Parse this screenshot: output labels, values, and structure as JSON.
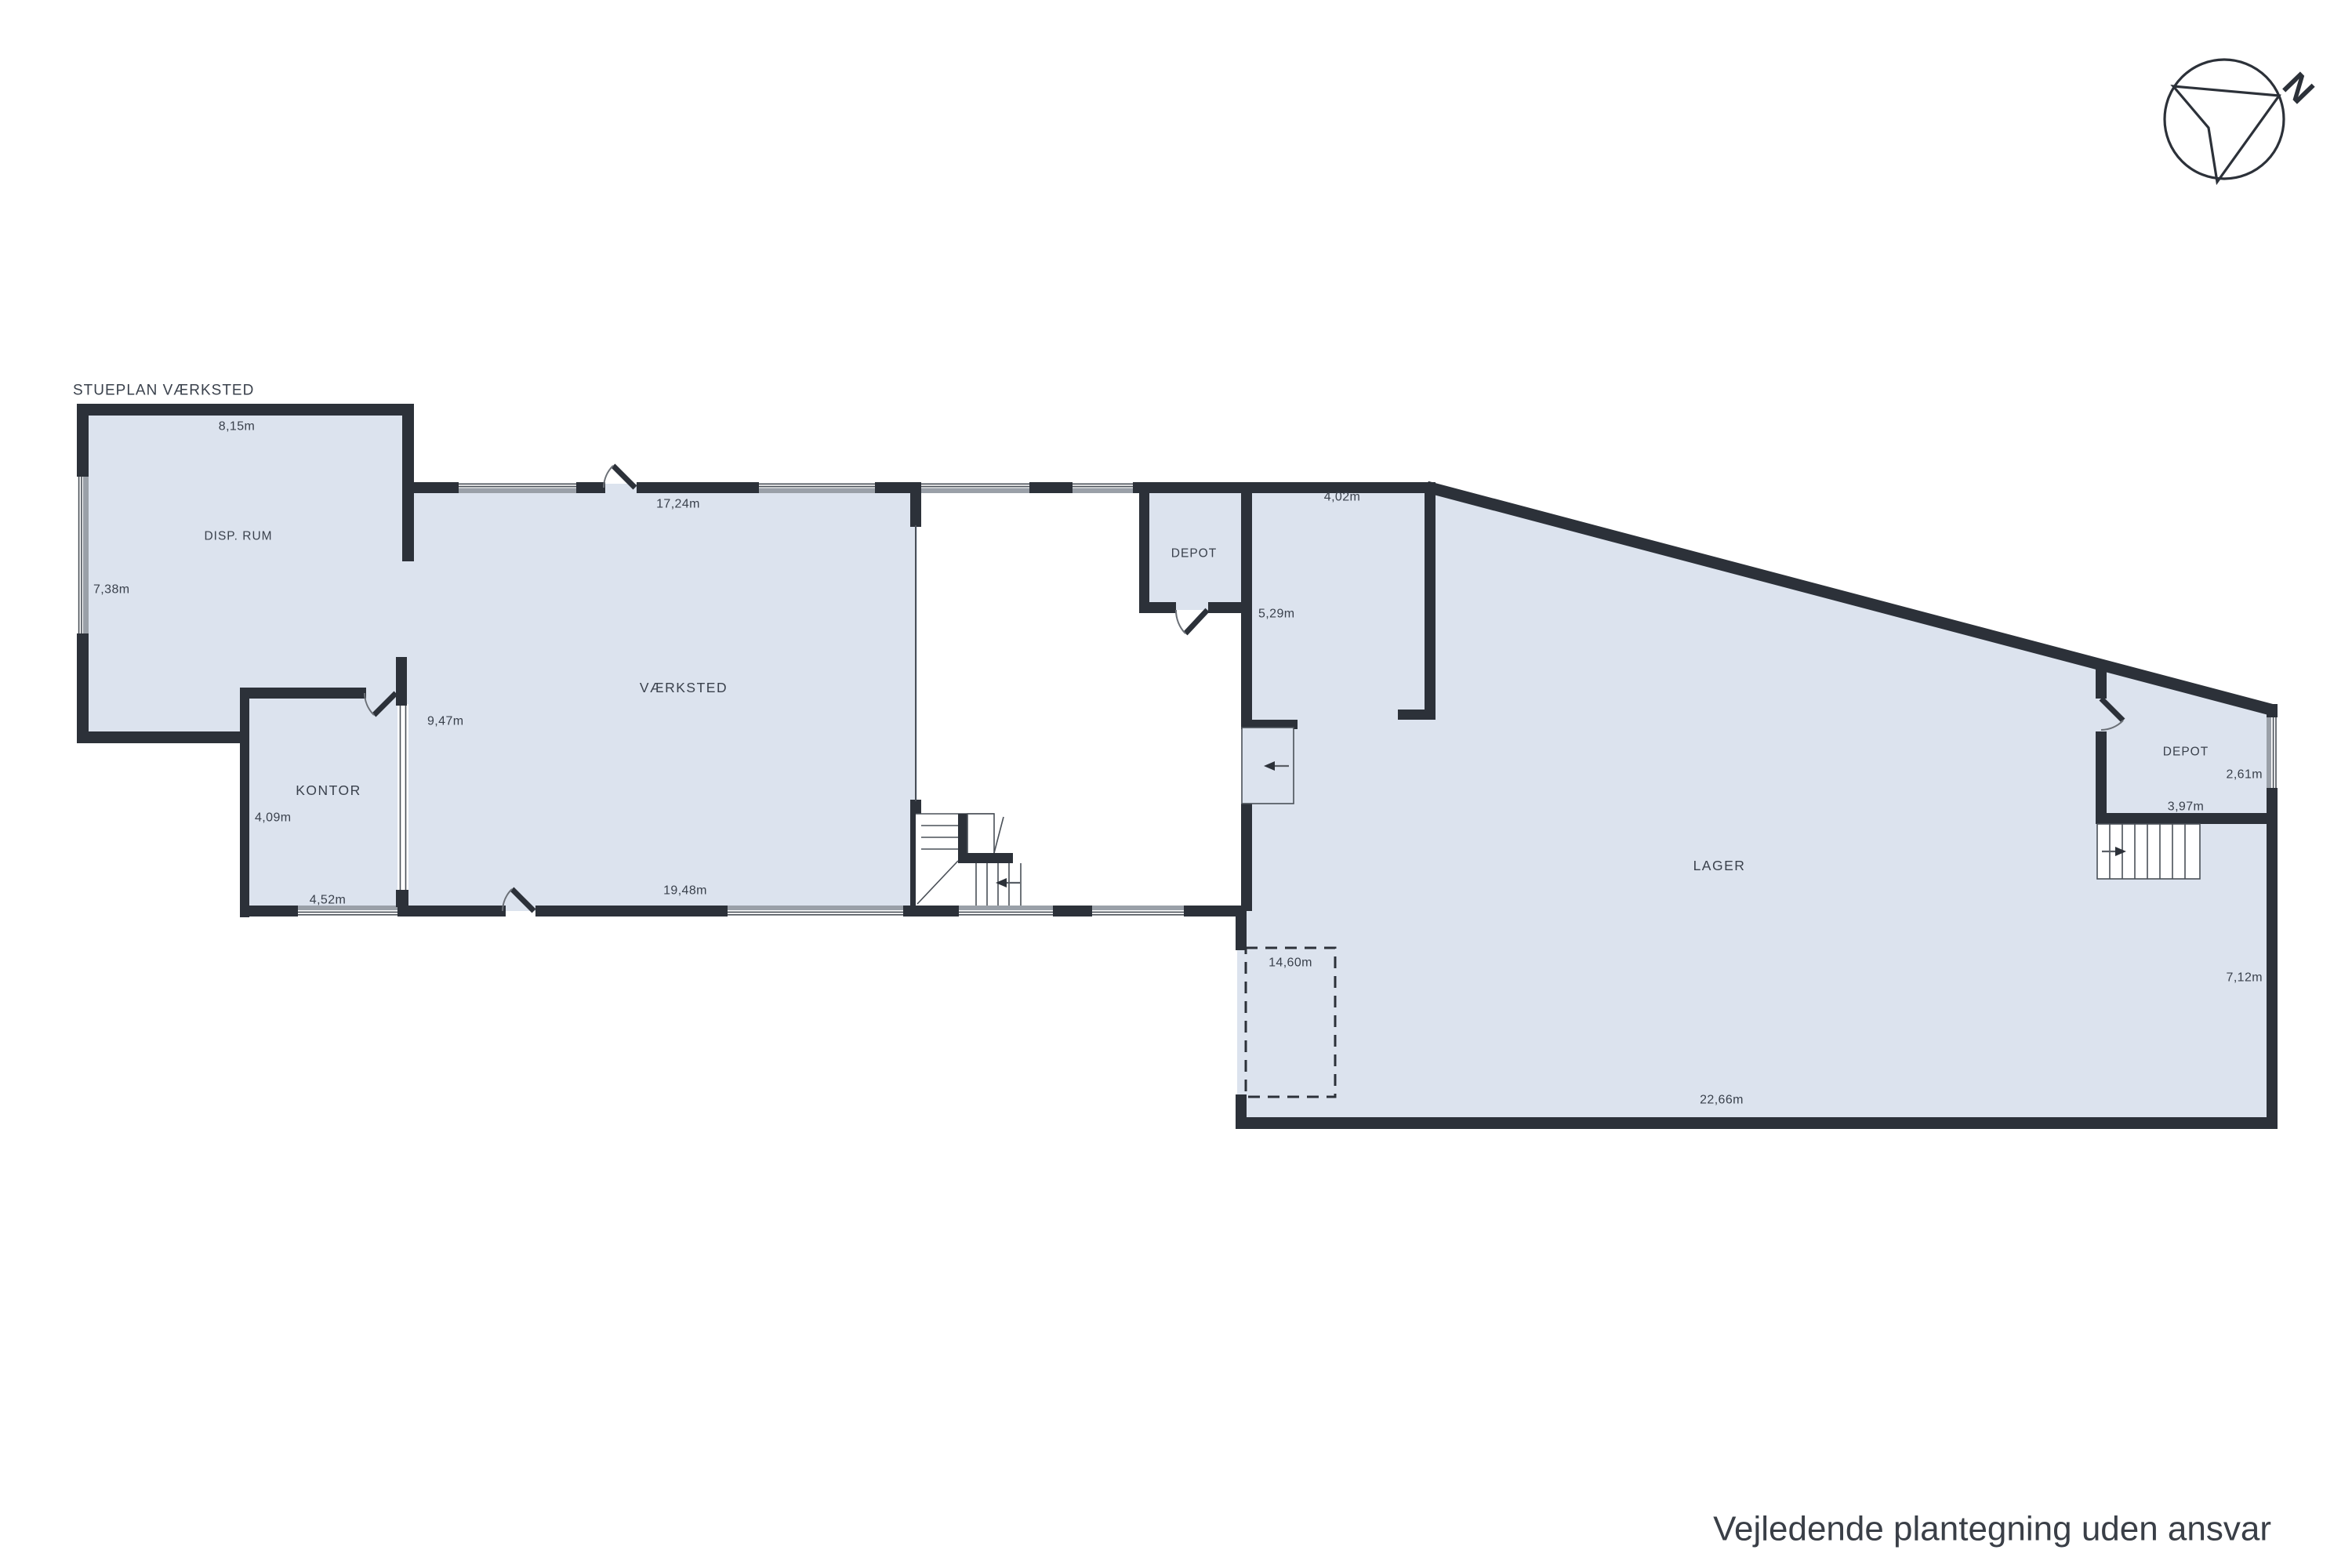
{
  "plan": {
    "title": "STUEPLAN VÆRKSTED",
    "disclaimer": "Vejledende plantegning uden ansvar",
    "compass": {
      "north_label": "N"
    },
    "colors": {
      "room_fill": "#dce3ee",
      "wall": "#2c3139",
      "window_gray": "#9aa0a8",
      "text": "#3a414c"
    },
    "rooms": [
      {
        "id": "disp-rum",
        "name": "DISP. RUM",
        "dims": {
          "top": "8,15m",
          "left": "7,38m"
        }
      },
      {
        "id": "vaerksted",
        "name": "VÆRKSTED",
        "dims": {
          "top": "17,24m",
          "left": "9,47m",
          "bottom": "19,48m"
        }
      },
      {
        "id": "kontor",
        "name": "KONTOR",
        "dims": {
          "left": "4,09m",
          "bottom": "4,52m"
        }
      },
      {
        "id": "depot-vest",
        "name": "DEPOT",
        "dims": {}
      },
      {
        "id": "lager",
        "name": "LAGER",
        "dims": {
          "section_top": "4,02m",
          "section_left": "5,29m",
          "gate": "14,60m",
          "bottom": "22,66m",
          "right": "7,12m"
        }
      },
      {
        "id": "depot-oest",
        "name": "DEPOT",
        "dims": {
          "right": "2,61m",
          "bottom": "3,97m"
        }
      }
    ]
  }
}
